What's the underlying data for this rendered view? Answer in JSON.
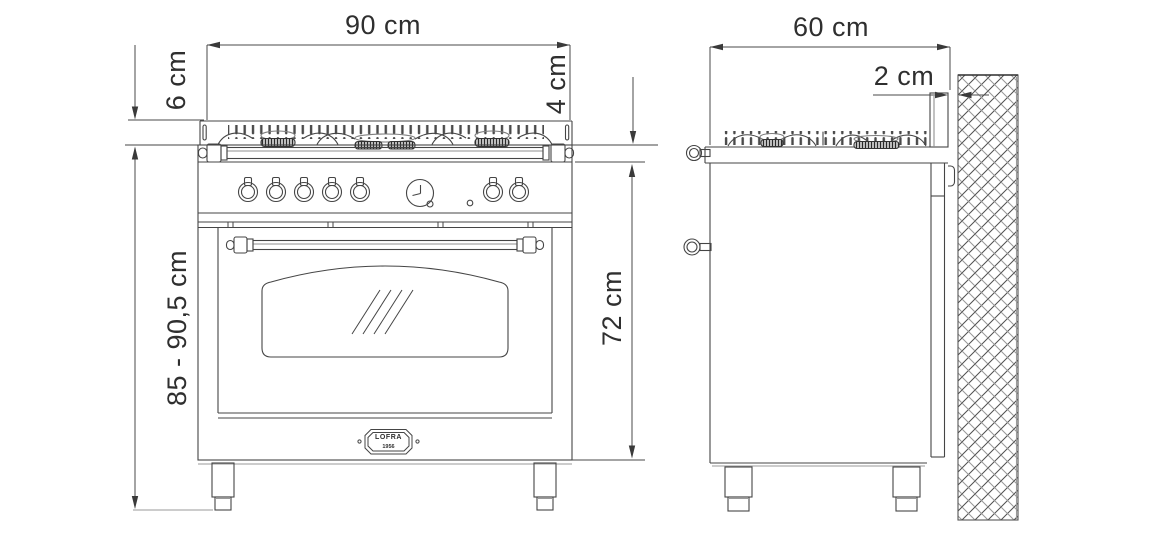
{
  "drawing": {
    "type": "appliance installation dimension drawing",
    "views": [
      "front",
      "side"
    ]
  },
  "dimensions": {
    "width": "90 cm",
    "upstand_height": "6 cm",
    "edge_height": "4 cm",
    "overall_height": "85 - 90,5 cm",
    "body_height": "72 cm",
    "depth": "60 cm",
    "wall_clearance": "2 cm"
  },
  "badge": {
    "brand": "LOFRA",
    "year": "1956"
  },
  "colors": {
    "background": "#ffffff",
    "line": "#454545",
    "light_line": "#9a9a9a",
    "arrow": "#3a3a3a",
    "text": "#2f2f2f"
  }
}
